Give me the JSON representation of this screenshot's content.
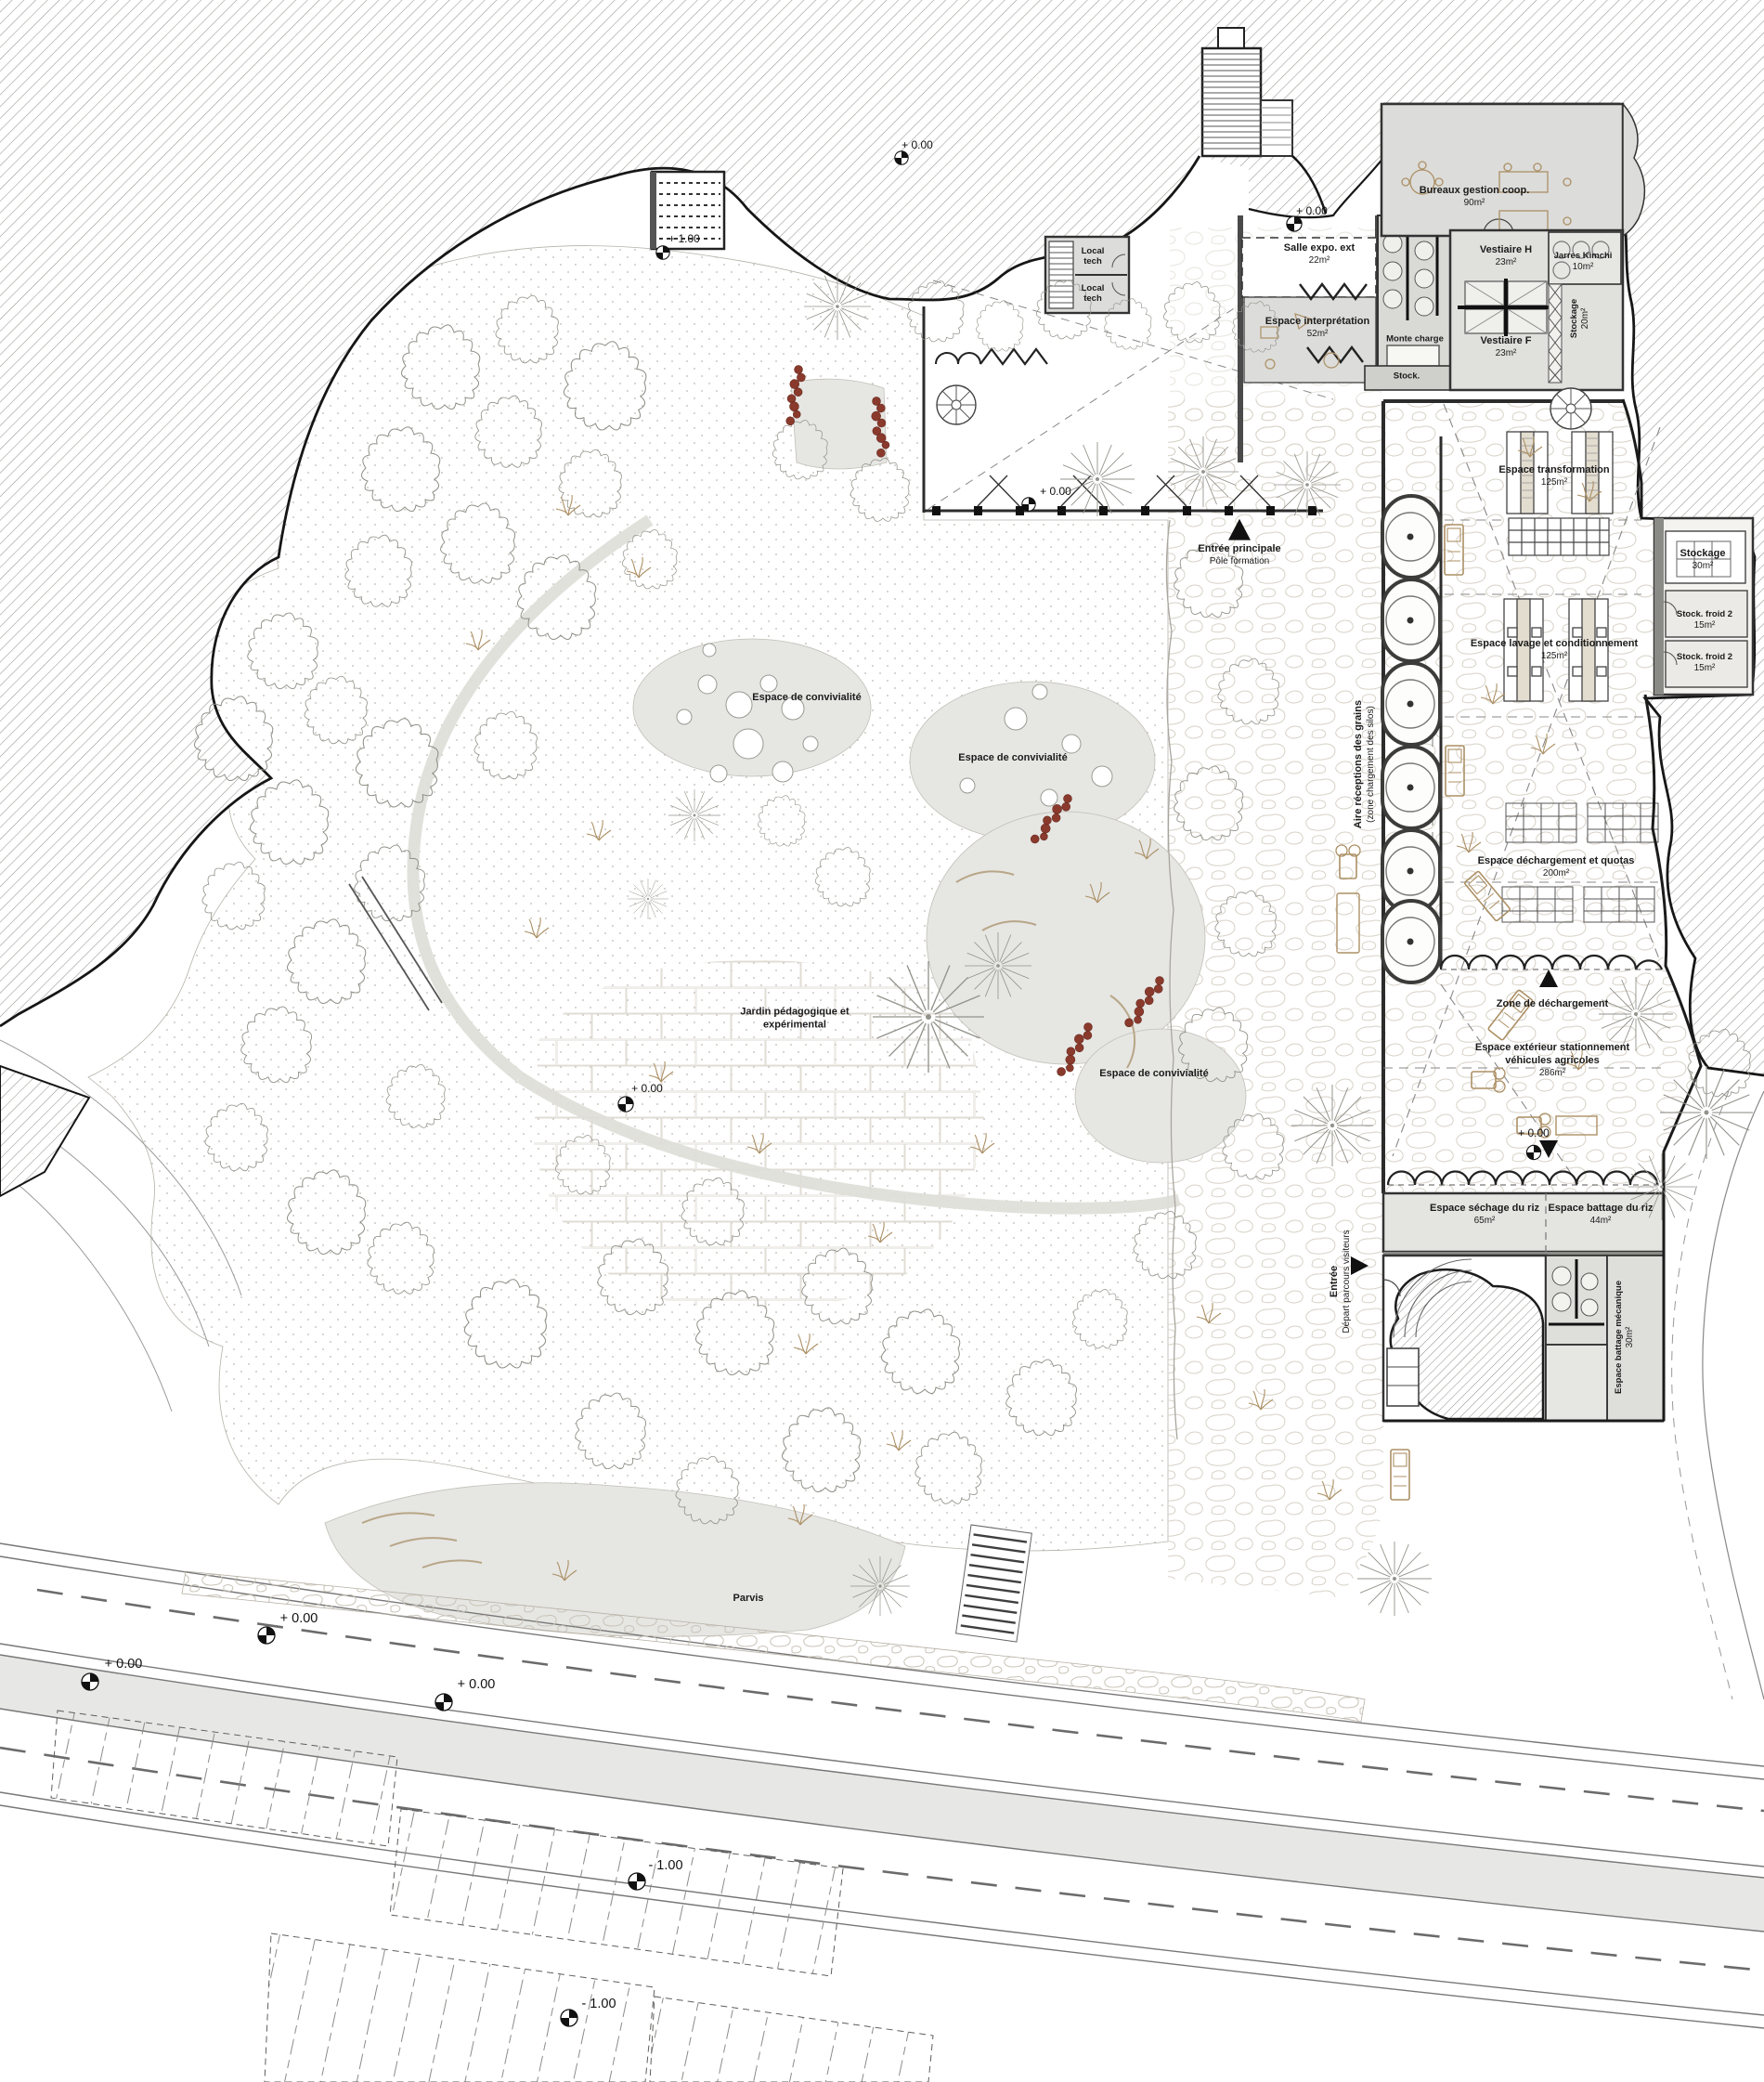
{
  "document": {
    "kind": "architectural site plan",
    "language": "fr"
  },
  "colors": {
    "paper": "#ffffff",
    "linework": "#2b2b2b",
    "room_fill": "#dcdcd9",
    "hatch_line": "#96948f",
    "stone_line": "#d7d2c7",
    "vegetation_line": "#8f8f88",
    "tan_accent": "#ac9065",
    "red_accent": "#8a3a2c",
    "grey_area": "#e6e6e3",
    "road_line": "#6f6f6f"
  },
  "rooms": [
    {
      "name": "Bureaux gestion coop.",
      "area": "90m²"
    },
    {
      "name": "Salle expo. ext",
      "area": "22m²"
    },
    {
      "name": "Espace interprétation",
      "area": "52m²"
    },
    {
      "name": "Monte charge",
      "area": ""
    },
    {
      "name": "Stock.",
      "area": ""
    },
    {
      "name": "Vestiaire H",
      "area": "23m²"
    },
    {
      "name": "Jarres Kimchi",
      "area": "10m²"
    },
    {
      "name": "Vestiaire F",
      "area": "23m²"
    },
    {
      "name": "Stockage",
      "area": "20m²"
    },
    {
      "name": "Espace transformation",
      "area": "125m²"
    },
    {
      "name": "Stockage",
      "area": "30m²"
    },
    {
      "name": "Stock. froid 2",
      "area": "15m²"
    },
    {
      "name": "Stock. froid 2",
      "area": "15m²"
    },
    {
      "name": "Espace lavage et conditionnement",
      "area": "125m²"
    },
    {
      "name": "Espace déchargement et quotas",
      "area": "200m²"
    },
    {
      "name": "Espace extérieur stationnement",
      "name2": "véhicules agricoles",
      "area": "286m²"
    },
    {
      "name": "Espace séchage du riz",
      "area": "65m²"
    },
    {
      "name": "Espace battage du riz",
      "area": "44m²"
    },
    {
      "name": "Espace battage mécanique",
      "area": "30m²"
    },
    {
      "name": "Local tech",
      "area": ""
    },
    {
      "name": "Local tech",
      "area": ""
    }
  ],
  "outdoor": {
    "zone_dechargement": "Zone de déchargement",
    "aire_receptions_1": "Aire réceptions des grains",
    "aire_receptions_2": "(zone chargement des silos)",
    "convivialite": "Espace de convivialité",
    "jardin_1": "Jardin pédagogique et",
    "jardin_2": "expérimental",
    "parvis": "Parvis"
  },
  "entrances": {
    "main_1": "Entrée principale",
    "main_2": "Pôle formation",
    "visitors_1": "Entrée",
    "visitors_2": "Départ parcours visiteurs"
  },
  "elevation_markers": [
    {
      "text": "+ 1.00"
    },
    {
      "text": "+ 0.00"
    },
    {
      "text": "+ 0.00"
    },
    {
      "text": "+ 0.00"
    },
    {
      "text": "+ 0.00"
    },
    {
      "text": "+ 0.00"
    },
    {
      "text": "+ 0.00"
    },
    {
      "text": "+ 0.00"
    },
    {
      "text": "+ 0.00"
    },
    {
      "text": "- 1.00"
    },
    {
      "text": "- 1.00"
    }
  ]
}
